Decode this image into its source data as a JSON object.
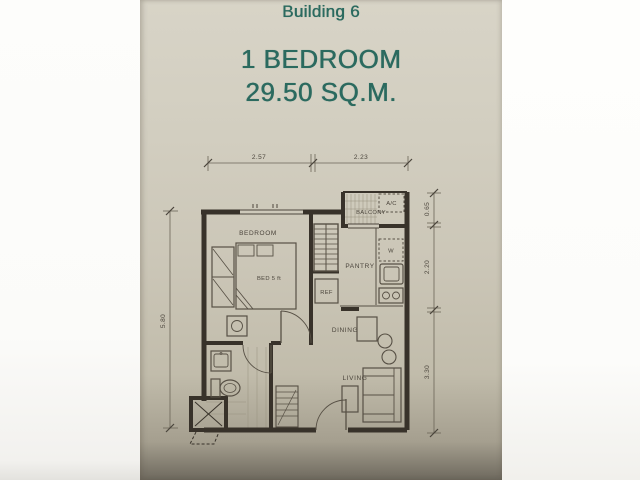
{
  "photo": {
    "header": {
      "building": "Building 6",
      "unit_type": "1 BEDROOM",
      "area": "29.50 SQ.M."
    },
    "colors": {
      "accent_teal": "#2b6a5f",
      "paper_beige": "#cbc6b7",
      "plan_ink": "#38322a"
    },
    "plan": {
      "room_labels": {
        "bedroom": "BEDROOM",
        "bed": "BED 5 ft",
        "balcony": "BALCONY",
        "ac_unit": "A/C",
        "washer": "W",
        "pantry": "PANTRY",
        "refrigerator": "REF",
        "dining": "DINING",
        "living": "LIVING"
      },
      "dimensions": {
        "top": [
          "2.57",
          "2.23"
        ],
        "left": [
          "5.80"
        ],
        "right": [
          "0.65",
          "2.20",
          "3.30"
        ]
      }
    }
  }
}
